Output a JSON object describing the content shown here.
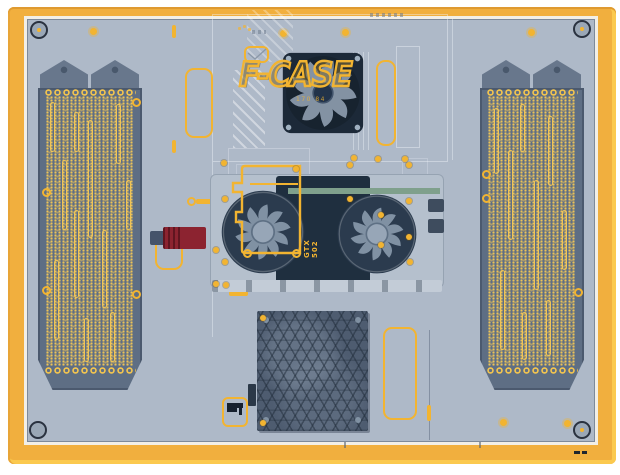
{
  "branding": {
    "logo_text": "F-CASE",
    "logo_sub_text": "170 84"
  },
  "gpu": {
    "model_label": "GTX 502"
  },
  "colors": {
    "frame_yellow": "#F1AF3E",
    "frame_yellow_light": "#FBC94F",
    "panel_gray": "#AEB9C8",
    "highlight_yellow": "#F2B431",
    "grille_dark": "#5E6E84",
    "grille_gold": "#F2C44F",
    "fan_navy": "#1C2938",
    "gpu_dark": "#1F2F3F",
    "psu_slate": "#4E5C70",
    "red_component": "#8C2330",
    "pcb_green": "#7FA08C"
  }
}
